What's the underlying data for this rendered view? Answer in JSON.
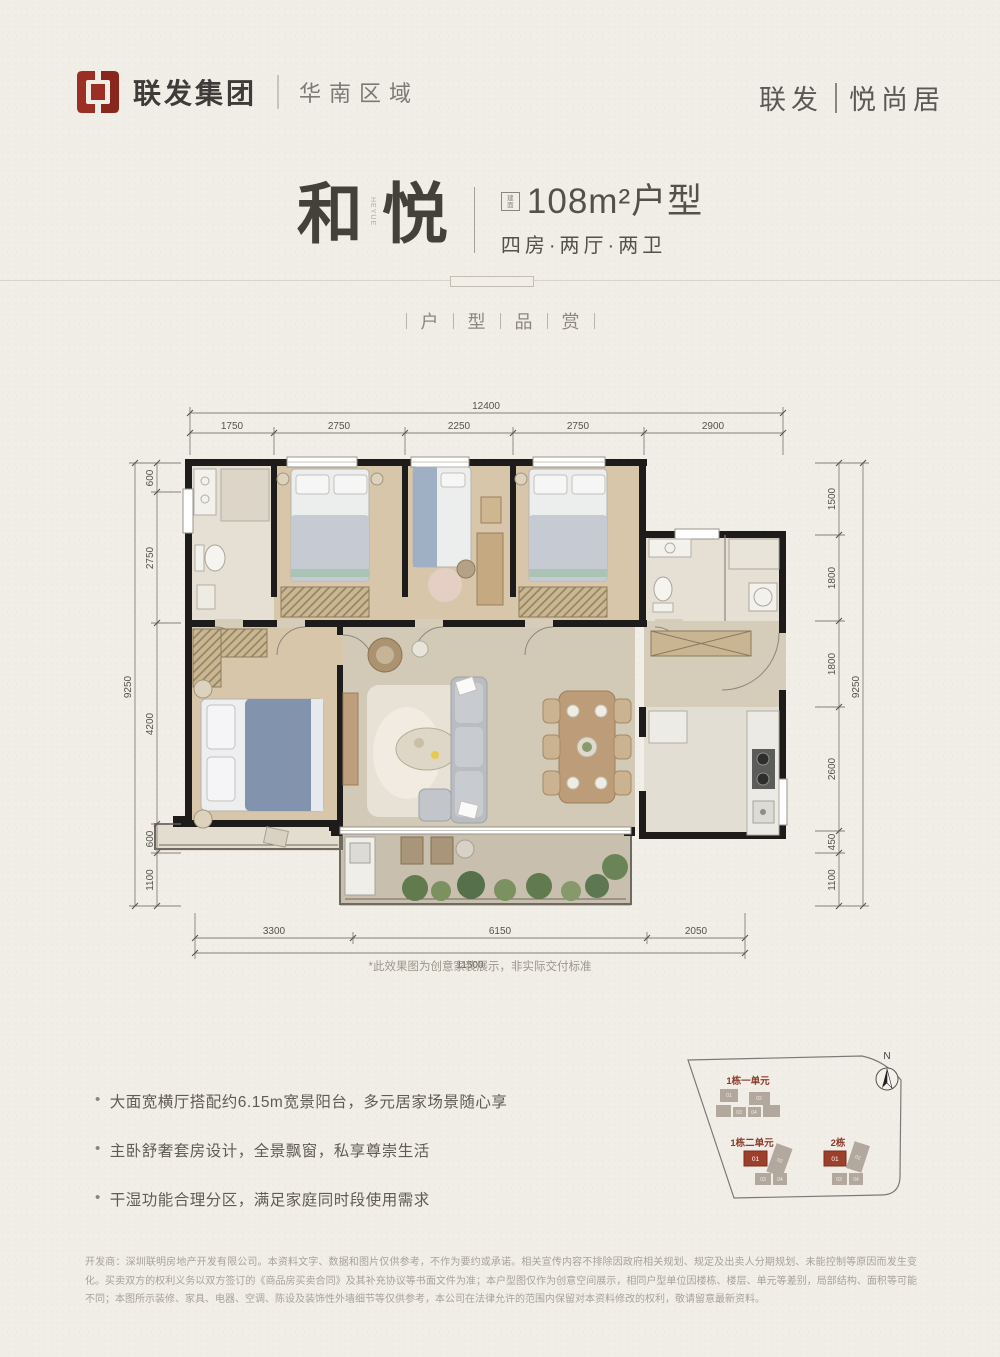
{
  "header": {
    "brand": "联发集团",
    "region": "华南区域",
    "project_left": "联发",
    "project_right": "悦尚居",
    "logo_color": "#9c2f23"
  },
  "title": {
    "char_left": "和",
    "char_right": "悦",
    "side_text": "HEYUE",
    "badge_char_1": "建",
    "badge_char_2": "面",
    "area": "108m²户型",
    "layout": "四房·两厅·两卫",
    "section": [
      "户",
      "型",
      "品",
      "赏"
    ]
  },
  "plan": {
    "note": "*此效果图为创意家装展示，非实际交付标准",
    "dims_top_total": "12400",
    "dims_top": [
      "1750",
      "2750",
      "2250",
      "2750",
      "2900"
    ],
    "dims_left_total": "9250",
    "dims_left": [
      "600",
      "2750",
      "4200",
      "600",
      "1100"
    ],
    "dims_right_total": "9250",
    "dims_right": [
      "1500",
      "1800",
      "1800",
      "2600",
      "450",
      "1100"
    ],
    "dims_bottom": [
      "3300",
      "6150",
      "2050"
    ],
    "dims_bottom_total": "11500"
  },
  "features": [
    "大面宽横厅搭配约6.15m宽景阳台，多元居家场景随心享",
    "主卧舒奢套房设计，全景飘窗，私享尊崇生活",
    "干湿功能合理分区，满足家庭同时段使用需求"
  ],
  "sitemap": {
    "north_label": "N",
    "cluster1_label": "1栋一单元",
    "cluster2_label": "1栋二单元",
    "cluster3_label": "2栋",
    "unit_01": "01",
    "unit_02": "02",
    "unit_03": "03",
    "unit_04": "04",
    "highlight_color": "#9c3f2b",
    "label_color": "#8c3a2a"
  },
  "disclaimer": "开发商：深圳联明房地产开发有限公司。本资料文字、数据和图片仅供参考，不作为要约或承诺。相关宣传内容不排除因政府相关规划、规定及出卖人分期规划、未能控制等原因而发生变化。买卖双方的权利义务以双方签订的《商品房买卖合同》及其补充协议等书面文件为准；本户型图仅作为创意空间展示，相同户型单位因楼栋、楼层、单元等差别，局部结构、面积等可能不同；本图所示装修、家具、电器、空调、陈设及装饰性外墙细节等仅供参考，本公司在法律允许的范围内保留对本资料修改的权利，敬请留意最新资料。"
}
